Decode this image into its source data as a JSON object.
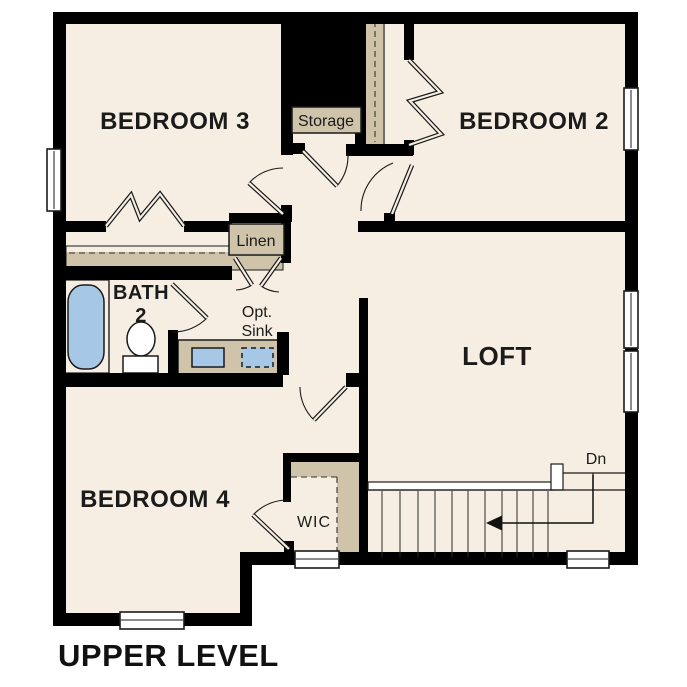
{
  "title": "UPPER LEVEL",
  "labels": {
    "bedroom3": "BEDROOM 3",
    "bedroom2": "BEDROOM 2",
    "bedroom4": "BEDROOM 4",
    "loft": "LOFT",
    "bath_line1": "BATH",
    "bath_line2": "2",
    "storage": "Storage",
    "linen": "Linen",
    "opt_sink_line1": "Opt.",
    "opt_sink_line2": "Sink",
    "wic": "WIC",
    "stair_direction": "Dn"
  },
  "colors": {
    "background": "#ffffff",
    "floor": "#f6eee2",
    "wall": "#000000",
    "closet_tan": "#cfc3aa",
    "fixture_blue": "#a7c7e6",
    "text": "#1b1b1b"
  }
}
